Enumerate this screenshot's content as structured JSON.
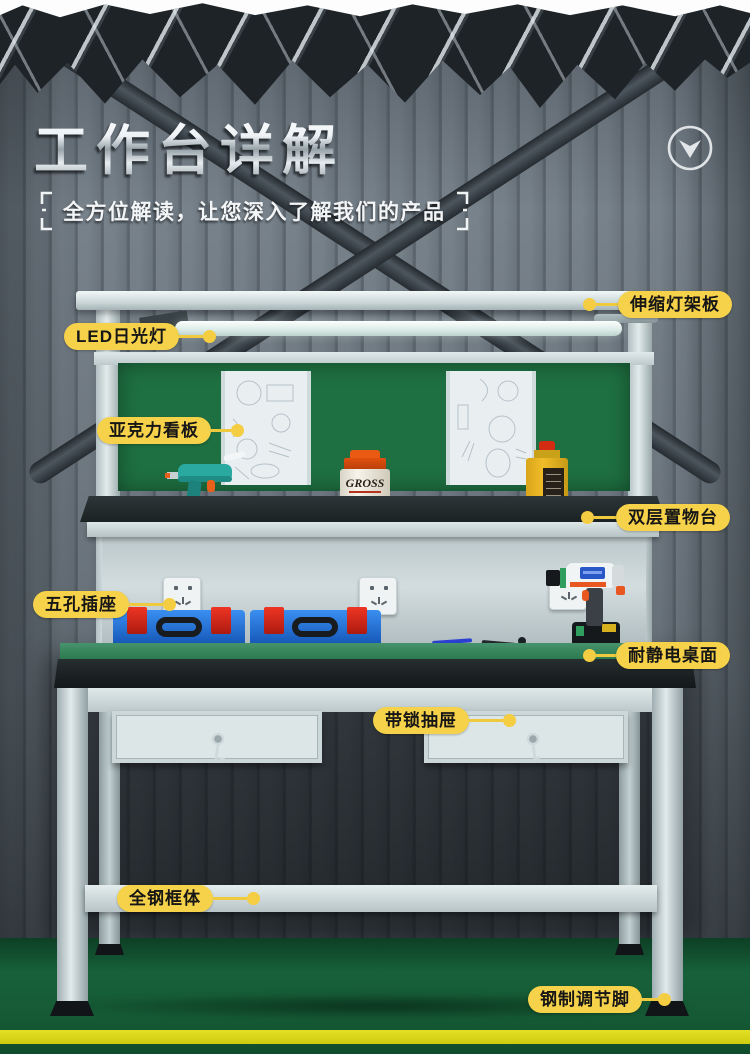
{
  "header": {
    "title": "工作台详解",
    "subtitle": "全方位解读，让您深入了解我们的产品"
  },
  "callouts": {
    "light_rack": "伸缩灯架板",
    "led_light": "LED日光灯",
    "acrylic_board": "亚克力看板",
    "double_shelf": "双层置物台",
    "five_hole_socket": "五孔插座",
    "antistatic_desktop": "耐静电桌面",
    "locking_drawer": "带锁抽屉",
    "steel_frame": "全钢框体",
    "adjustable_feet": "钢制调节脚"
  },
  "items": {
    "jar_label": "GROSS"
  },
  "colors": {
    "callout_yellow": "#F6D24A",
    "kanban_green": "#1E6F41",
    "worktop_green": "#2A794D",
    "floor_green": "#155C33",
    "floor_stripe_yellow": "#D8D51A",
    "wall_gray": "#717B84",
    "plate_dark": "#1D2327"
  }
}
